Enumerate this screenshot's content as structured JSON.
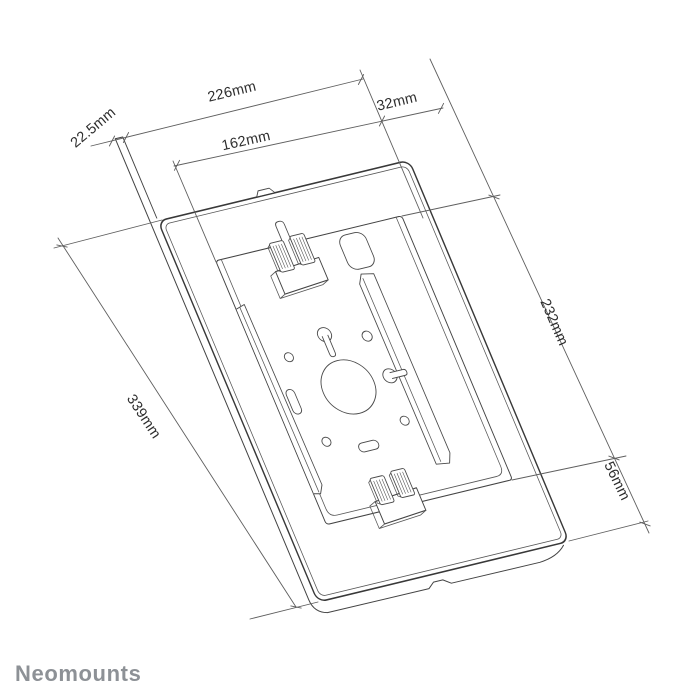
{
  "labels": {
    "d226": "226mm",
    "d22_5": "22.5mm",
    "d162": "162mm",
    "d32": "32mm",
    "d232": "232mm",
    "d339": "339mm",
    "d56": "56mm"
  },
  "brand": {
    "logo_text": "Neomounts"
  },
  "colors": {
    "background": "#ffffff",
    "drawing_line": "#383838",
    "dimension_line": "#5f5f5f",
    "label_text": "#2d2d2d",
    "logo_gray": "#8d9196"
  }
}
